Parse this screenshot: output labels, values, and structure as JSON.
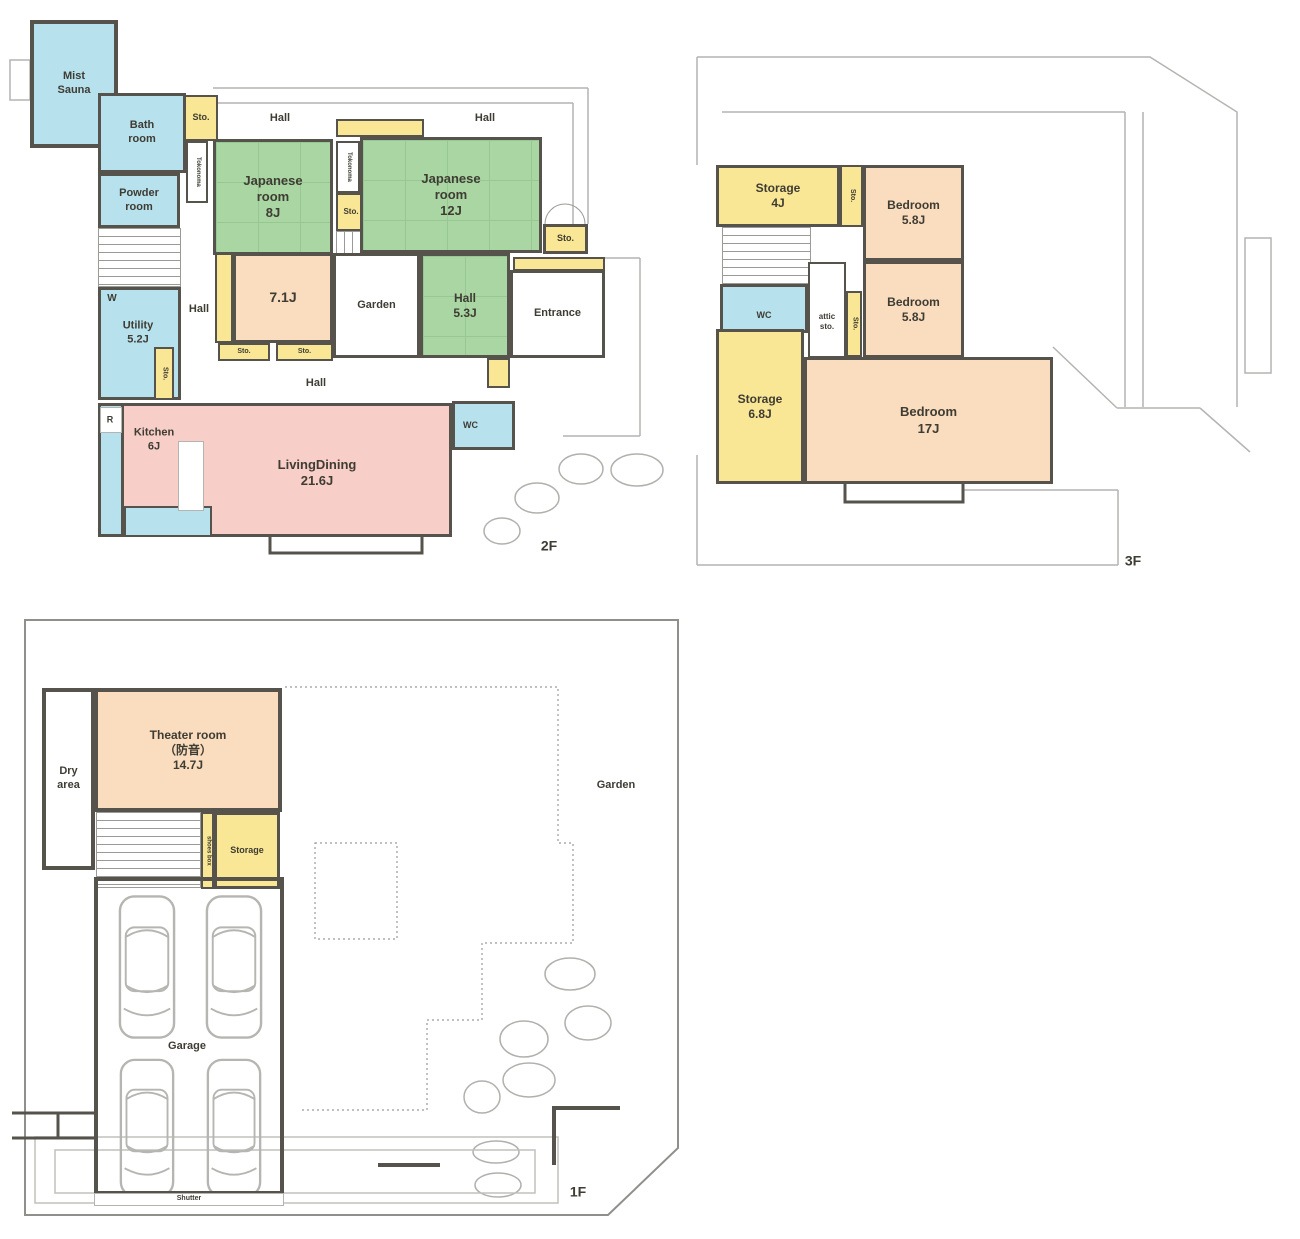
{
  "common": {
    "sto": "Sto.",
    "hall": "Hall",
    "wc": "WC",
    "garden": "Garden",
    "tokonoma": "Tokonoma",
    "storage": "Storage"
  },
  "floor2": {
    "label": "2F",
    "mist_sauna": "Mist\nSauna",
    "bath": "Bath\nroom",
    "powder": "Powder\nroom",
    "jp8": "Japanese\nroom\n8J",
    "jp12": "Japanese\nroom\n12J",
    "room71": "7.1J",
    "hall53": "Hall\n5.3J",
    "entrance": "Entrance",
    "w": "W",
    "utility": "Utility\n5.2J",
    "r": "R",
    "kitchen": "Kitchen\n6J",
    "living": "LivingDining\n21.6J"
  },
  "floor3": {
    "label": "3F",
    "storage4": "Storage\n4J",
    "bedroom58": "Bedroom\n5.8J",
    "attic": "attic\nsto.",
    "storage68": "Storage\n6.8J",
    "bedroom17": "Bedroom\n17J"
  },
  "floor1": {
    "label": "1F",
    "dry": "Dry\narea",
    "theater": "Theater room\n（防音）\n14.7J",
    "shoes": "shoes box",
    "garage": "Garage",
    "shutter": "Shutter"
  }
}
